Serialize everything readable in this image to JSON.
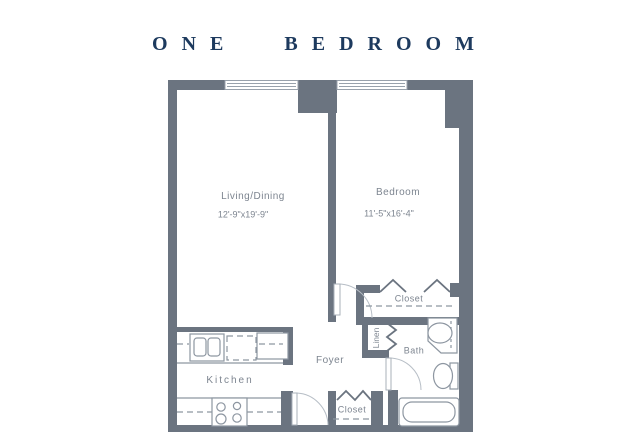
{
  "title": "ONE BEDROOM",
  "colors": {
    "wall": "#6b7480",
    "title": "#1d3a5e",
    "label": "#7d8590",
    "fixture": "#8d96a1"
  },
  "rooms": {
    "living": {
      "name": "Living/Dining",
      "dimensions": "12'-9\"x19'-9\""
    },
    "bedroom": {
      "name": "Bedroom",
      "dimensions": "11'-5\"x16'-4\""
    },
    "kitchen": {
      "name": "Kitchen"
    },
    "foyer": {
      "name": "Foyer"
    },
    "bath": {
      "name": "Bath"
    },
    "bedroom_closet": {
      "name": "Closet"
    },
    "entry_closet": {
      "name": "Closet"
    },
    "linen": {
      "name": "Linen"
    }
  },
  "fixtures": {
    "windows": 2,
    "kitchen_sink": "double-basin",
    "dishwasher": "dashed-outline",
    "refrigerator": "solid-outline",
    "stove_burners": 4,
    "bathtub": 1,
    "toilet": 1,
    "vanity_sink": 1
  }
}
